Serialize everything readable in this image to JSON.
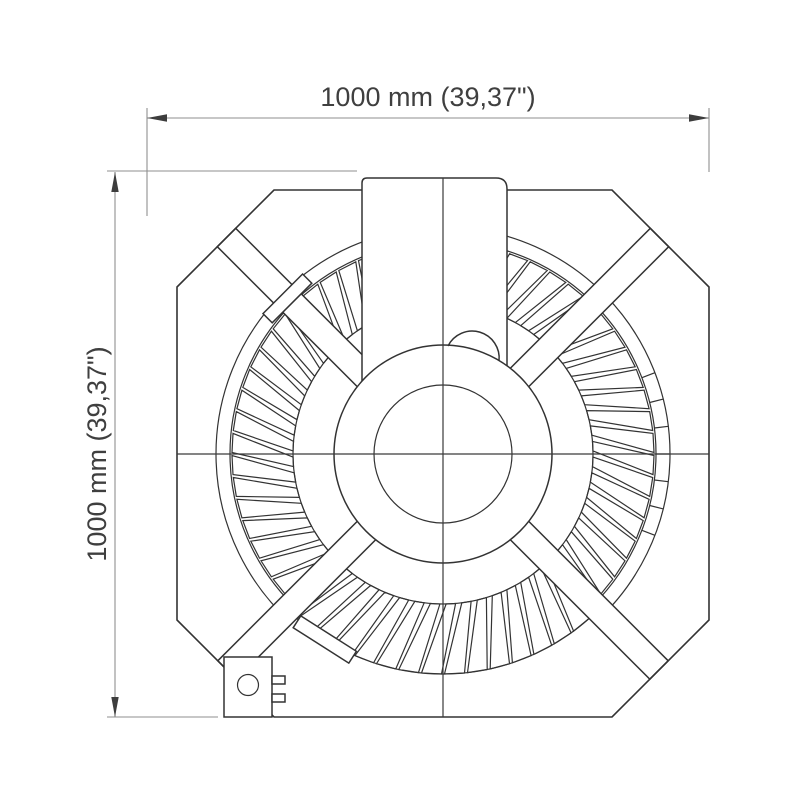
{
  "figure": {
    "width_dimension_label": "1000 mm (39,37\")",
    "height_dimension_label": "1000 mm (39,37\")"
  },
  "colors": {
    "background": "#ffffff",
    "drawing_line": "#333333",
    "dimension_line": "#8f8f8f",
    "dimension_text": "#3f3f3f"
  }
}
